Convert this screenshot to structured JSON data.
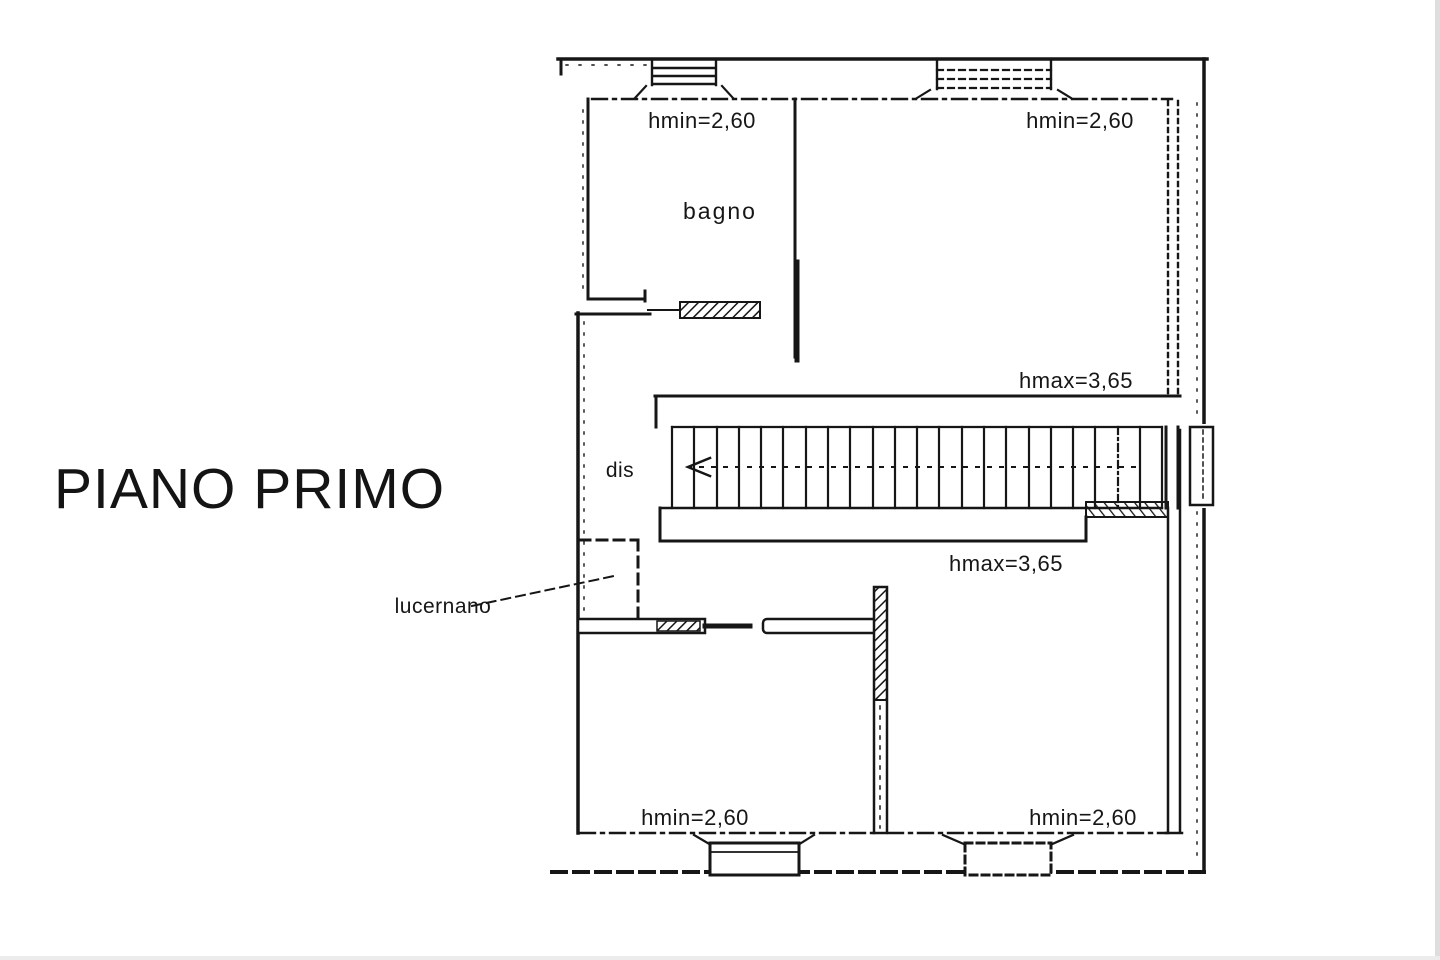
{
  "document": {
    "title": "PIANO PRIMO"
  },
  "floor_plan": {
    "labels": {
      "bagno": "bagno",
      "dis": "dis",
      "lucernano": "lucernano"
    },
    "heights": {
      "top_left": "hmin=2,60",
      "top_right": "hmin=2,60",
      "stair_upper": "hmax=3,65",
      "stair_lower": "hmax=3,65",
      "bottom_left": "hmin=2,60",
      "bottom_right": "hmin=2,60"
    },
    "colors": {
      "ink": "#161616",
      "paper": "#ffffff"
    }
  }
}
